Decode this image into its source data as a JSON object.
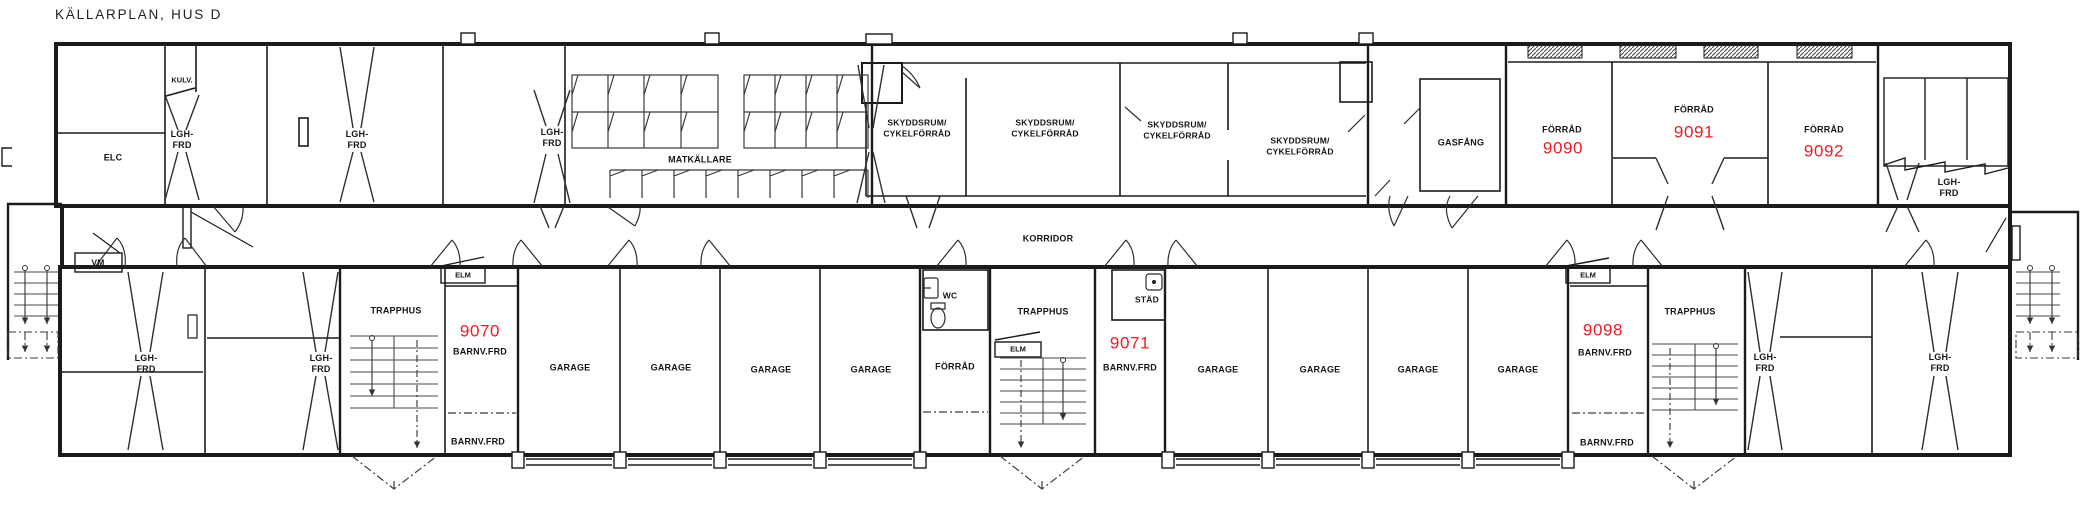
{
  "title": "KÄLLARPLAN, HUS D",
  "colors": {
    "accent_red": "#ED1C24",
    "line": "#1b1b1b",
    "background": "#ffffff"
  },
  "rooms": {
    "kulv": "KULV.",
    "elc": "ELC",
    "lgh_frd": "LGH-\nFRD",
    "matkallare": "MATKÄLLARE",
    "skyddsrum": "SKYDDSRUM/\nCYKELFÖRRÅD",
    "gasfang": "GASFÅNG",
    "forrad": "FÖRRÅD",
    "korridor": "KORRIDOR",
    "vm": "VM",
    "trapphus": "TRAPPHUS",
    "elm": "ELM",
    "garage": "GARAGE",
    "wc": "WC",
    "stad": "STÄD",
    "barnv_frd": "BARNV.FRD"
  },
  "units": [
    {
      "type": "FÖRRÅD",
      "number": "9090"
    },
    {
      "type": "FÖRRÅD",
      "number": "9091"
    },
    {
      "type": "FÖRRÅD",
      "number": "9092"
    },
    {
      "type": "BARNV.FRD",
      "number": "9070"
    },
    {
      "type": "BARNV.FRD",
      "number": "9071"
    },
    {
      "type": "BARNV.FRD",
      "number": "9098"
    }
  ]
}
